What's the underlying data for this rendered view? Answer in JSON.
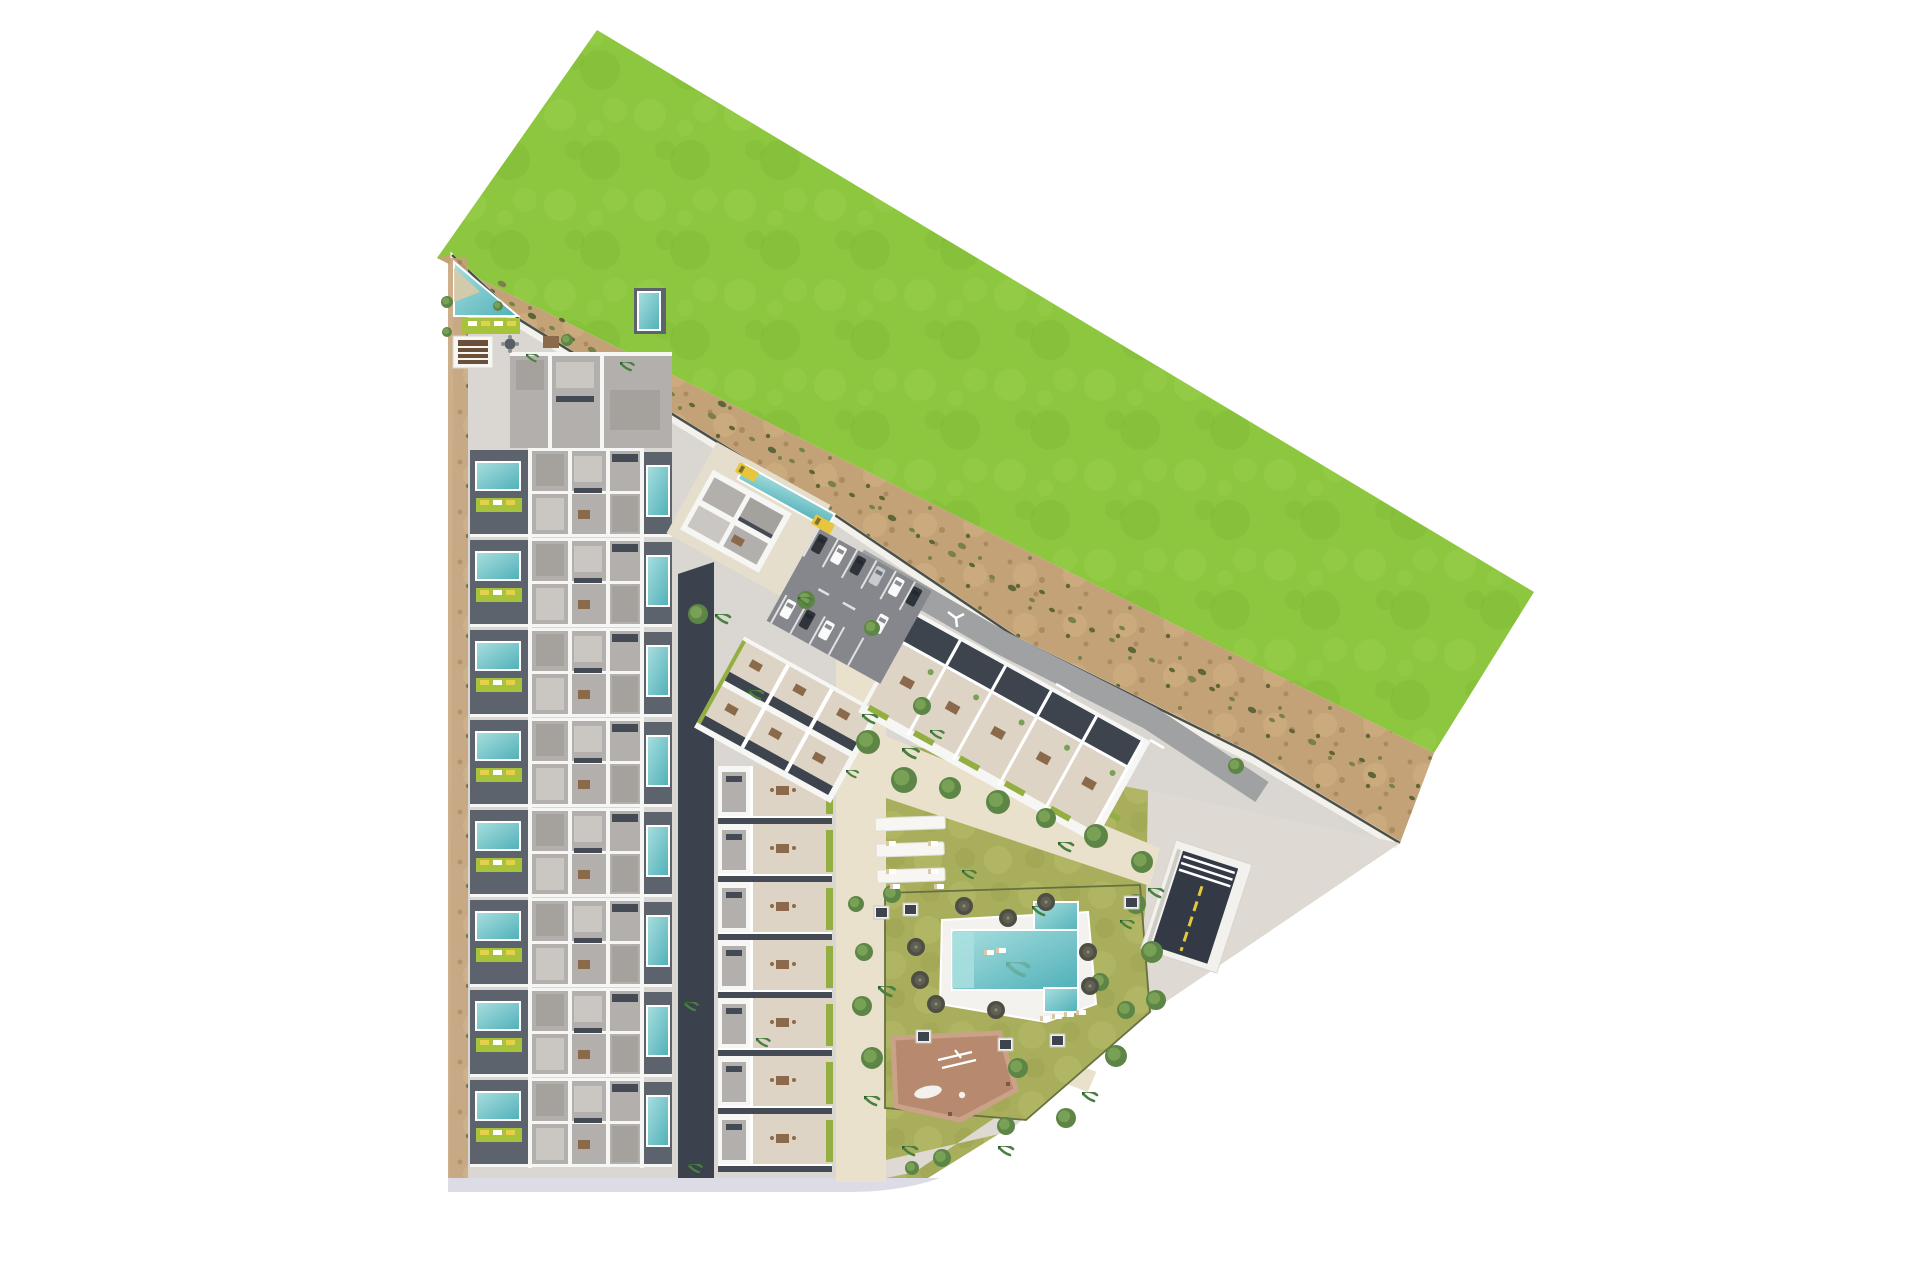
{
  "meta": {
    "description": "Aerial top-down architectural site plan rendering of a coastal residential development: rows of townhouses with private pools on the west side, rotated apartment blocks and a parking lot in the centre, a landscaped amenity garden with a large swimming pool, pergolas and a playground to the south-east, a sandy buffer strip with shrubs and a large bright green field to the north-east."
  },
  "palette": {
    "grass_base": "#8dc63f",
    "grass_light": "#9bd14f",
    "grass_dark": "#7eb835",
    "sand_base": "#c4a277",
    "sand_light": "#d1b186",
    "sand_dark": "#aa8a5e",
    "tuft": "#5e6637",
    "tuft2": "#7a8148",
    "site_bg": "#dad6d1",
    "path_beige": "#e9e1cb",
    "east_pave": "#ded9d2",
    "road_gray": "#9fa1a3",
    "asphalt": "#85878c",
    "alley": "#3b424e",
    "house_gray": "#b3afac",
    "deck_gray": "#a5a19d",
    "patio_dark": "#5d636c",
    "pool_teal": "#5fb9bf",
    "pool_light": "#a9dfdf",
    "lime": "#a7c33c",
    "lounger_yellow": "#e5d04b",
    "terrace_cream": "#ddd4c5",
    "roof_dark": "#3e444e",
    "hedge": "#93af41",
    "lawn_base": "#a9ae5c",
    "lawn_light": "#b8bd6a",
    "lawn_dark": "#98a04c",
    "tree_dark": "#5d8545",
    "tree_mid": "#79a156",
    "palm": "#49803f",
    "play_base": "#b78a6f",
    "play_edge": "#c9a288",
    "ramp_dark": "#333a46",
    "ramp_yellow": "#e3c93f",
    "car_white": "#fafafa",
    "car_dark": "#2f343b",
    "car_silver": "#c7cbce",
    "car_yellow": "#e7c53d",
    "pale_road": "#dcdce6",
    "wall_line": "#4b5048",
    "table_brown": "#8a6a4a"
  },
  "units": {
    "townhouse": {
      "count": 8,
      "x": 470,
      "y0": 448,
      "pitch": 90
    },
    "garden_apartments": {
      "count": 7,
      "x": 718,
      "y0": 766,
      "pitch": 58
    },
    "block_b": {
      "count": 5,
      "pitch": 52
    }
  },
  "scatter": {
    "trees": [
      [
        868,
        742,
        12
      ],
      [
        904,
        780,
        13
      ],
      [
        950,
        788,
        11
      ],
      [
        998,
        802,
        12
      ],
      [
        1046,
        818,
        10
      ],
      [
        1096,
        836,
        12
      ],
      [
        1142,
        862,
        11
      ],
      [
        892,
        894,
        9
      ],
      [
        1136,
        904,
        10
      ],
      [
        1152,
        952,
        11
      ],
      [
        1156,
        1000,
        10
      ],
      [
        864,
        952,
        9
      ],
      [
        862,
        1006,
        10
      ],
      [
        872,
        1058,
        11
      ],
      [
        1018,
        1068,
        10
      ],
      [
        1116,
        1056,
        11
      ],
      [
        1066,
        1118,
        10
      ],
      [
        1006,
        1126,
        9
      ],
      [
        942,
        1158,
        9
      ],
      [
        1100,
        982,
        9
      ],
      [
        856,
        904,
        8
      ],
      [
        1126,
        1010,
        9
      ],
      [
        698,
        614,
        10
      ],
      [
        806,
        600,
        9
      ],
      [
        1236,
        766,
        8
      ],
      [
        912,
        1168,
        7
      ],
      [
        872,
        628,
        8
      ],
      [
        922,
        706,
        9
      ],
      [
        447,
        302,
        6
      ],
      [
        447,
        332,
        5
      ],
      [
        498,
        306,
        5
      ],
      [
        567,
        340,
        6
      ]
    ],
    "palms": [
      [
        715,
        614,
        1
      ],
      [
        798,
        597,
        0.9
      ],
      [
        748,
        690,
        1
      ],
      [
        862,
        714,
        1
      ],
      [
        902,
        748,
        1.1
      ],
      [
        1058,
        842,
        1
      ],
      [
        1148,
        888,
        1
      ],
      [
        878,
        986,
        1.1
      ],
      [
        864,
        1096,
        1
      ],
      [
        902,
        1146,
        1
      ],
      [
        998,
        1146,
        1
      ],
      [
        1082,
        1092,
        1
      ],
      [
        1032,
        906,
        1
      ],
      [
        684,
        1002,
        0.9
      ],
      [
        688,
        1164,
        0.9
      ],
      [
        620,
        362,
        0.9
      ],
      [
        526,
        354,
        0.8
      ],
      [
        962,
        870,
        0.9
      ],
      [
        756,
        1038,
        0.9
      ],
      [
        930,
        730,
        0.9
      ],
      [
        846,
        770,
        0.8
      ],
      [
        1120,
        920,
        0.9
      ]
    ],
    "umbrellas": [
      [
        916,
        947
      ],
      [
        920,
        980
      ],
      [
        1008,
        918
      ],
      [
        1088,
        952
      ],
      [
        1090,
        986
      ],
      [
        936,
        1004
      ],
      [
        964,
        906
      ],
      [
        1046,
        902
      ],
      [
        996,
        1010
      ]
    ],
    "kiosks": [
      [
        903,
        903
      ],
      [
        1124,
        896
      ],
      [
        916,
        1030
      ],
      [
        998,
        1038
      ],
      [
        1050,
        1034
      ],
      [
        874,
        906
      ]
    ],
    "loungers": [
      [
        886,
        841
      ],
      [
        928,
        841
      ],
      [
        886,
        869
      ],
      [
        928,
        869
      ],
      [
        890,
        884
      ],
      [
        934,
        884
      ],
      [
        1040,
        1016
      ],
      [
        1052,
        1014
      ],
      [
        1064,
        1012
      ],
      [
        1076,
        1010
      ],
      [
        984,
        950
      ],
      [
        996,
        948
      ]
    ],
    "shrub_tufts": [
      [
        472,
        279
      ],
      [
        492,
        291
      ],
      [
        512,
        304
      ],
      [
        532,
        316
      ],
      [
        552,
        328
      ],
      [
        572,
        339
      ],
      [
        592,
        350
      ],
      [
        612,
        361
      ],
      [
        632,
        372
      ],
      [
        652,
        383
      ],
      [
        672,
        394
      ],
      [
        692,
        405
      ],
      [
        712,
        416
      ],
      [
        732,
        428
      ],
      [
        752,
        439
      ],
      [
        772,
        450
      ],
      [
        792,
        461
      ],
      [
        812,
        472
      ],
      [
        832,
        484
      ],
      [
        852,
        495
      ],
      [
        872,
        507
      ],
      [
        892,
        518
      ],
      [
        912,
        530
      ],
      [
        932,
        542
      ],
      [
        952,
        554
      ],
      [
        972,
        565
      ],
      [
        992,
        577
      ],
      [
        1012,
        588
      ],
      [
        1032,
        600
      ],
      [
        1052,
        610
      ],
      [
        1072,
        620
      ],
      [
        1092,
        630
      ],
      [
        1112,
        640
      ],
      [
        1132,
        650
      ],
      [
        1152,
        660
      ],
      [
        1172,
        670
      ],
      [
        1192,
        679
      ],
      [
        1212,
        689
      ],
      [
        1232,
        699
      ],
      [
        1252,
        710
      ],
      [
        1272,
        720
      ],
      [
        1292,
        731
      ],
      [
        1312,
        742
      ],
      [
        1332,
        753
      ],
      [
        1352,
        764
      ],
      [
        1372,
        775
      ],
      [
        1392,
        786
      ],
      [
        1412,
        798
      ],
      [
        502,
        284
      ],
      [
        562,
        320
      ],
      [
        642,
        360
      ],
      [
        722,
        404
      ],
      [
        802,
        450
      ],
      [
        882,
        498
      ],
      [
        962,
        546
      ],
      [
        1042,
        592
      ],
      [
        1122,
        628
      ],
      [
        1202,
        672
      ],
      [
        1282,
        716
      ],
      [
        1362,
        760
      ]
    ],
    "cars": [
      [
        4,
        4,
        "car_dark"
      ],
      [
        26,
        4,
        "car_white"
      ],
      [
        48,
        4,
        "car_dark"
      ],
      [
        70,
        4,
        "car_silver"
      ],
      [
        92,
        4,
        "car_white"
      ],
      [
        8,
        76,
        "car_white"
      ],
      [
        30,
        76,
        "car_dark"
      ],
      [
        52,
        76,
        "car_white"
      ],
      [
        96,
        44,
        "car_white"
      ],
      [
        112,
        4,
        "car_dark"
      ]
    ],
    "shuttles": [
      [
        740,
        462
      ],
      [
        816,
        514
      ]
    ]
  }
}
